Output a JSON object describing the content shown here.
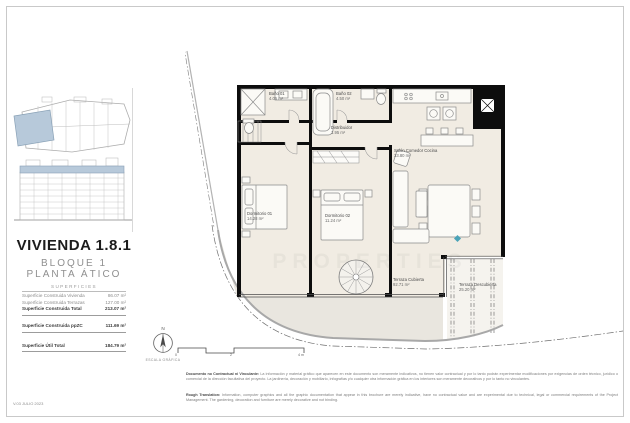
{
  "sidebar": {
    "title": "VIVIENDA 1.8.1",
    "block_line": "BLOQUE 1",
    "floor_line": "PLANTA ÁTICO",
    "table": {
      "heading": "SUPERFICIES",
      "rows": [
        {
          "label": "Superficie Construida Vivienda",
          "value": "86.07 m²"
        },
        {
          "label": "Superficie Construida Terrazas",
          "value": "127.00 m²"
        },
        {
          "label": "Superficie Construida Total",
          "value": "213.07 m²"
        },
        {
          "label": "Superficie Construida ppZC",
          "value": "111.69 m²"
        },
        {
          "label": "Superficie Útil Total",
          "value": "184.79 m²"
        }
      ]
    }
  },
  "plan": {
    "rooms": {
      "bano1": {
        "name": "Baño 01",
        "area": "4.05 m²"
      },
      "bano2": {
        "name": "Baño 02",
        "area": "4.50 m²"
      },
      "distribuidor": {
        "name": "Distribuidor",
        "area": "1.95 m²"
      },
      "salon": {
        "name": "Salón Comedor Cocina",
        "area": "33.80 m²"
      },
      "dormitorio1": {
        "name": "Dormitorio 01",
        "area": "14.28 m²"
      },
      "dormitorio2": {
        "name": "Dormitorio 02",
        "area": "11.24 m²"
      },
      "terraza_cubierta": {
        "name": "Terraza Cubierta",
        "area": "92.71 m²"
      },
      "terraza_descubierta": {
        "name": "Terraza Descubierta",
        "area": "25.20 m²"
      }
    },
    "watermark": "PROPERTIES"
  },
  "compass": {
    "north": "N",
    "scale_caption": "ESCALA GRÁFICA"
  },
  "scalebar": {
    "ticks": [
      "0",
      "2",
      "4 m"
    ]
  },
  "footer": {
    "version": "V.03 JULIO 2023",
    "disclaimer_es_lead": "Documento no Contractual ni Vinculante:",
    "disclaimer_es": "La información y material gráfico que aparecen en este documento son meramente indicativos, no tienen valor contractual y por lo tanto podrán experimentar modificaciones por exigencias de orden técnico, jurídico o comercial de la dirección facultativa del proyecto. La jardinería, decoración y mobiliario, infografías y/o cualquier otra información gráfica en los interiores son meramente decorativos y por lo tanto no vinculantes.",
    "disclaimer_en_lead": "Rough Translation:",
    "disclaimer_en": "Information, computer graphics and all the graphic documentation that appear in this brochure are merely indicative, have no contractual value and are experimental due to technical, legal or commercial requirements of the Project Management. The gardening, decoration and furniture are merely decorative and not binding."
  },
  "colors": {
    "highlight_blue": "#b7c9da",
    "floor_beige": "#f1ece3",
    "terrace_grey": "#e9e6df",
    "wall_black": "#0d0d0d"
  }
}
